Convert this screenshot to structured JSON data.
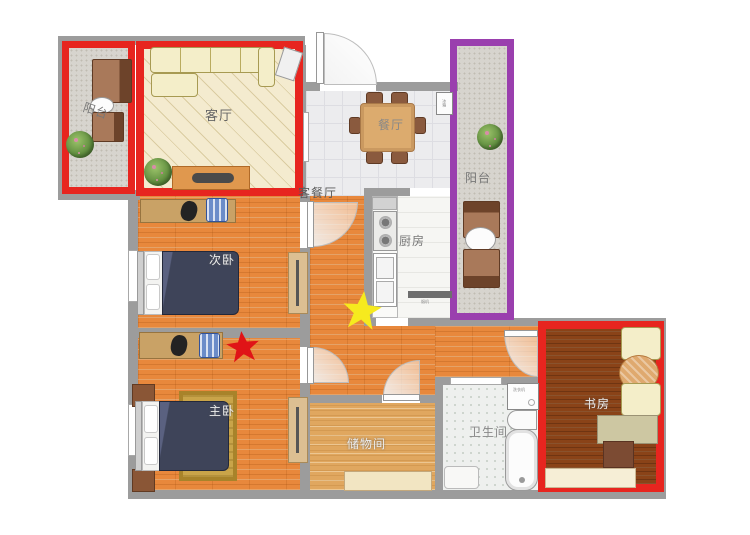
{
  "colors": {
    "wall": "#9c9c9c",
    "red_annotation": "#e7251f",
    "purple_annotation": "#9a3fae",
    "wood_floor": "#e8883c",
    "star_red": "#e01417",
    "star_yellow": "#f6ea1e"
  },
  "rooms": {
    "living": {
      "label": "客厅"
    },
    "dining": {
      "label": "餐厅"
    },
    "living_dining": {
      "label": "客餐厅"
    },
    "kitchen": {
      "label": "厨房"
    },
    "balcony_top": {
      "label": "阳台"
    },
    "balcony_right": {
      "label": "阳台"
    },
    "bedroom_second": {
      "label": "次卧"
    },
    "bedroom_master": {
      "label": "主卧"
    },
    "storage": {
      "label": "储物间"
    },
    "bathroom": {
      "label": "卫生间"
    },
    "study": {
      "label": "书房"
    }
  },
  "appliances": {
    "fridge": {
      "label": "冰箱"
    },
    "range_hood": {
      "label": "烟机"
    },
    "washer": {
      "label": "洗衣机"
    }
  }
}
